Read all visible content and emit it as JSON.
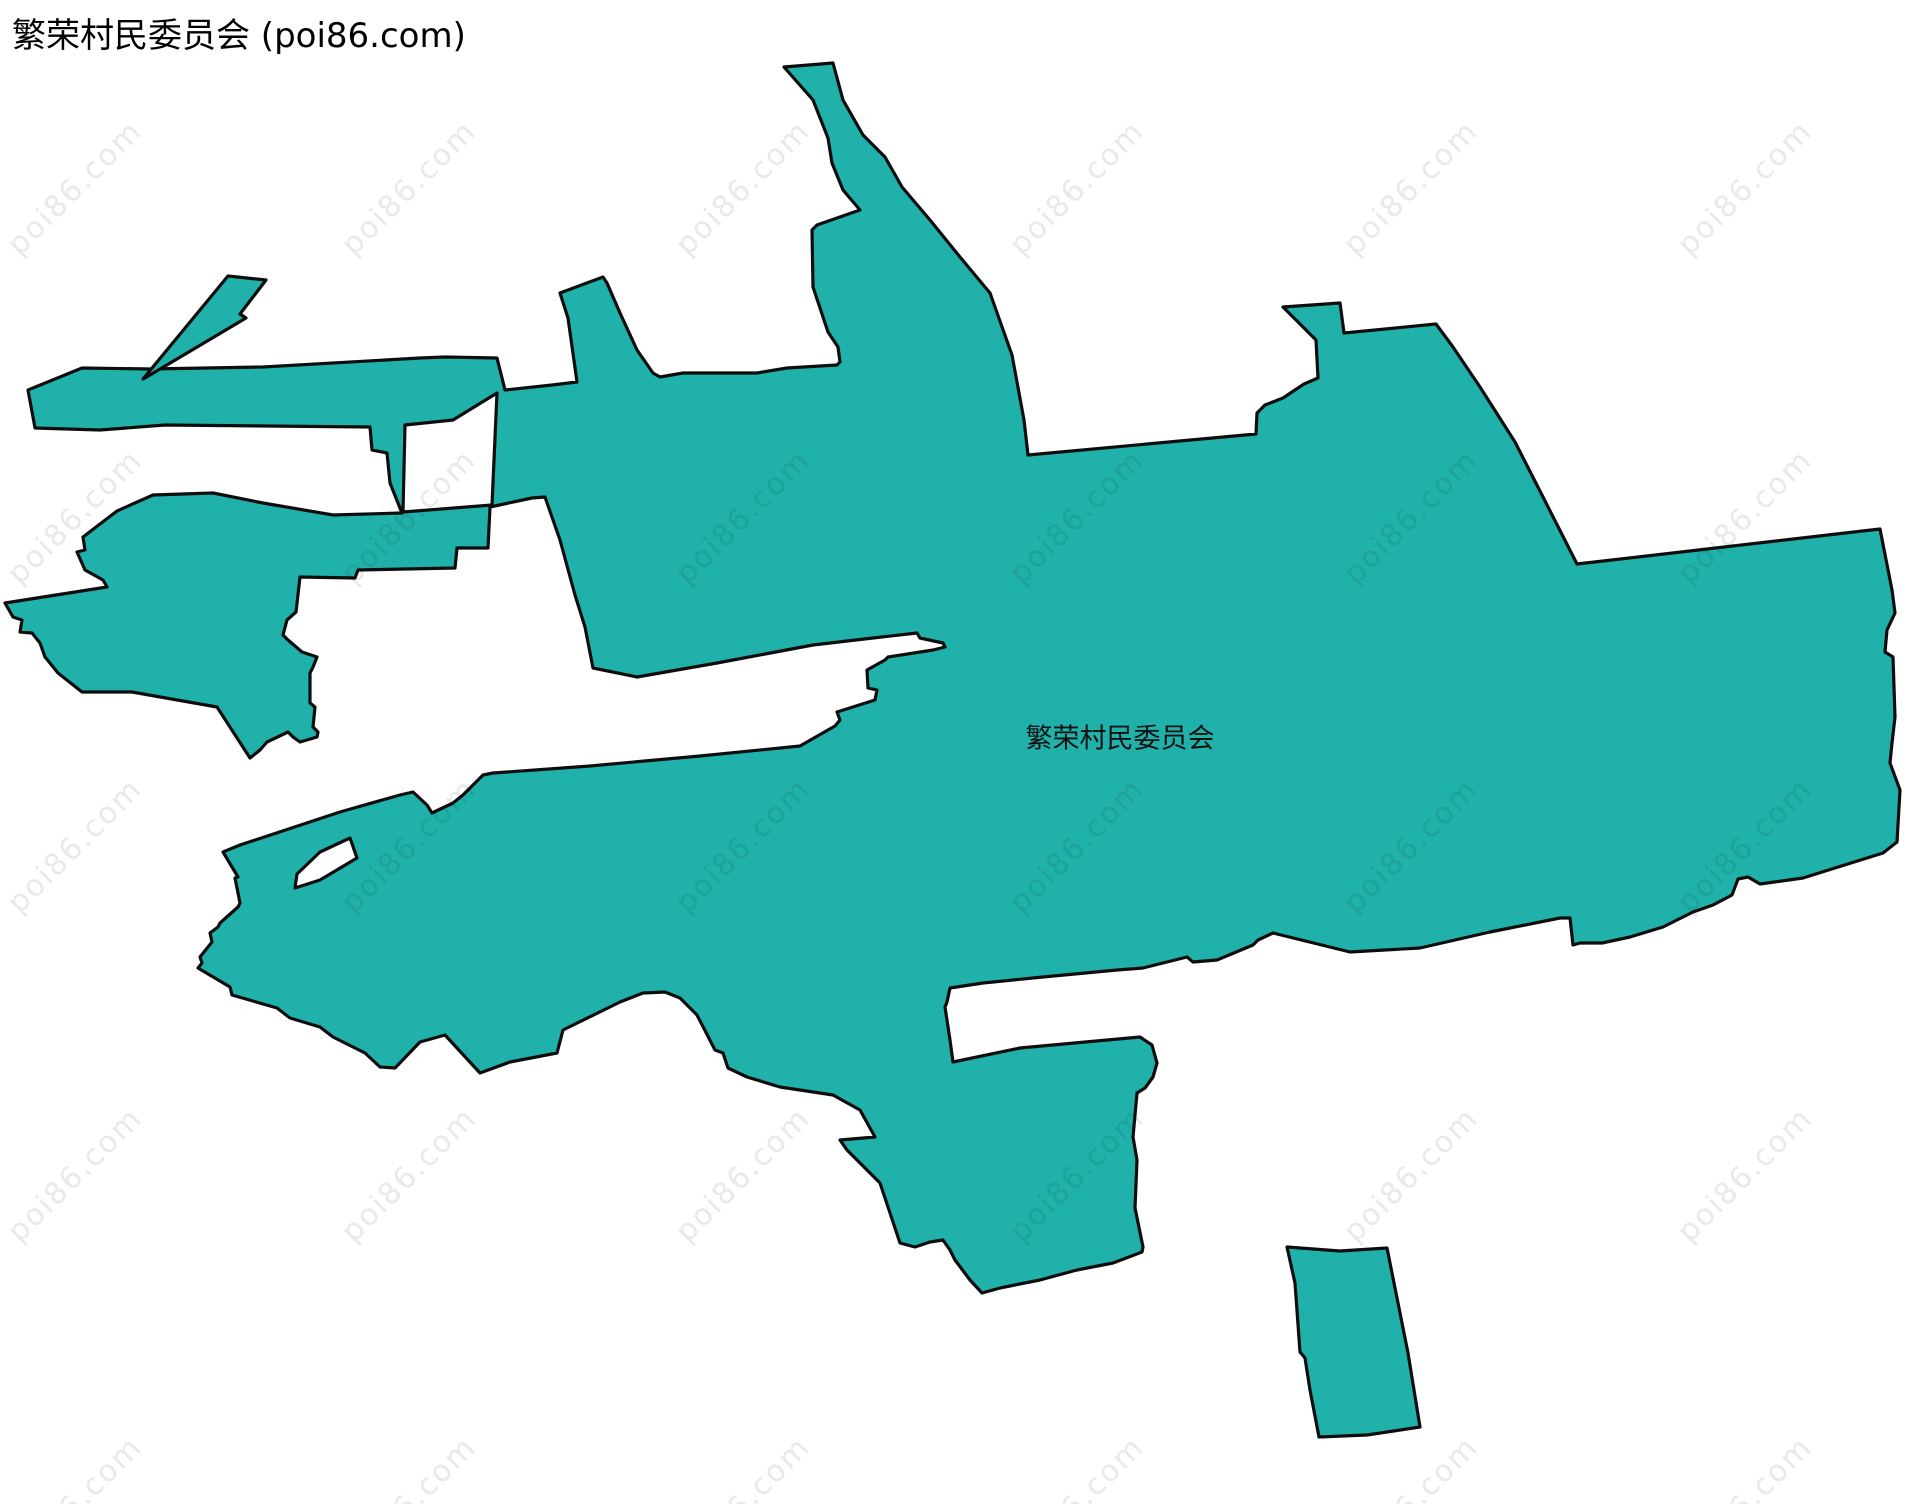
{
  "header": {
    "title": "繁荣村民委员会 (poi86.com)"
  },
  "map": {
    "region_label": "繁荣村民委员会",
    "region_fill": "#20B2AA",
    "region_stroke": "#0d0d0d",
    "background": "#ffffff",
    "watermark": {
      "text": "poi86.com",
      "color": "#e9e9e9"
    }
  }
}
